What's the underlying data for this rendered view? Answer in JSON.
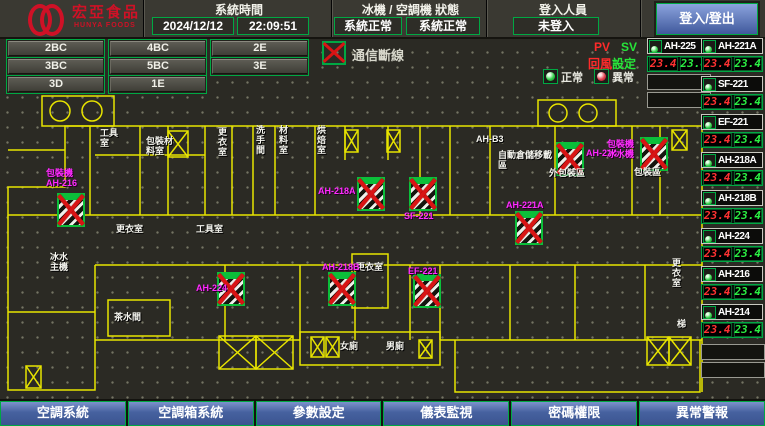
{
  "header": {
    "logo": {
      "name": "宏亞食品",
      "sub": "HUNYA FOODS"
    },
    "time_section": {
      "label": "系統時間",
      "date": "2024/12/12",
      "time": "22:09:51"
    },
    "status_section": {
      "label": "冰機 / 空調機 狀態",
      "chiller": "系統正常",
      "ahu": "系統正常"
    },
    "login_section": {
      "label": "登入人員",
      "user": "未登入"
    },
    "login_button": "登入/登出"
  },
  "floor_buttons": [
    "2BC",
    "4BC",
    "2E",
    "3BC",
    "5BC",
    "3E",
    "3D",
    "1E"
  ],
  "comm_status": "通信斷線",
  "legend": {
    "normal": "正常",
    "abnormal": "異常"
  },
  "readout_header": {
    "pv": "PV",
    "sv": "SV",
    "pv_name": "回風",
    "sv_name": "設定"
  },
  "units_left": [
    {
      "name": "AH-225",
      "pv": "23.4",
      "sv": "23.4"
    }
  ],
  "units_right": [
    {
      "name": "AH-221A",
      "pv": "23.4",
      "sv": "23.4"
    },
    {
      "name": "SF-221",
      "pv": "23.4",
      "sv": "23.4"
    },
    {
      "name": "EF-221",
      "pv": "23.4",
      "sv": "23.4"
    },
    {
      "name": "AH-218A",
      "pv": "23.4",
      "sv": "23.4"
    },
    {
      "name": "AH-218B",
      "pv": "23.4",
      "sv": "23.4"
    },
    {
      "name": "AH-224",
      "pv": "23.4",
      "sv": "23.4"
    },
    {
      "name": "AH-216",
      "pv": "23.4",
      "sv": "23.4"
    },
    {
      "name": "AH-214",
      "pv": "23.4",
      "sv": "23.4"
    }
  ],
  "plan": {
    "units": [
      {
        "label": "包裝機\nAH-216"
      },
      {
        "label": "AH-218A"
      },
      {
        "label": "SF-221"
      },
      {
        "label": "AH-214"
      },
      {
        "label": "包裝機\n冰水機"
      },
      {
        "label": "AH-221A"
      },
      {
        "label": "AH-218B"
      },
      {
        "label": "EF-221"
      },
      {
        "label": "AH-224"
      }
    ],
    "rooms": [
      {
        "text": "工具室"
      },
      {
        "text": "包裝材料室"
      },
      {
        "text": "更衣室"
      },
      {
        "text": "洗手間"
      },
      {
        "text": "材料室"
      },
      {
        "text": "烘焙室"
      },
      {
        "text": "AH-B3"
      },
      {
        "text": "自動倉儲移載區"
      },
      {
        "text": "外包裝區"
      },
      {
        "text": "包裝區"
      },
      {
        "text": "更衣室"
      },
      {
        "text": "工具室"
      },
      {
        "text": "冰水\n主機"
      },
      {
        "text": "茶水間"
      },
      {
        "text": "更衣室"
      },
      {
        "text": "女廁"
      },
      {
        "text": "男廁"
      },
      {
        "text": "更衣室"
      },
      {
        "text": "梯"
      }
    ]
  },
  "bottom_tabs": [
    "空調系統",
    "空調箱系統",
    "參數設定",
    "儀表監視",
    "密碼權限",
    "異常警報"
  ],
  "colors": {
    "accent_green": "#00a843",
    "alarm_red": "#d91414",
    "magenta": "#ff2bff",
    "wall_yellow": "#e8e400",
    "pv_red": "#ff3232",
    "sv_green": "#2bef43",
    "tab_blue": "#46619f"
  }
}
